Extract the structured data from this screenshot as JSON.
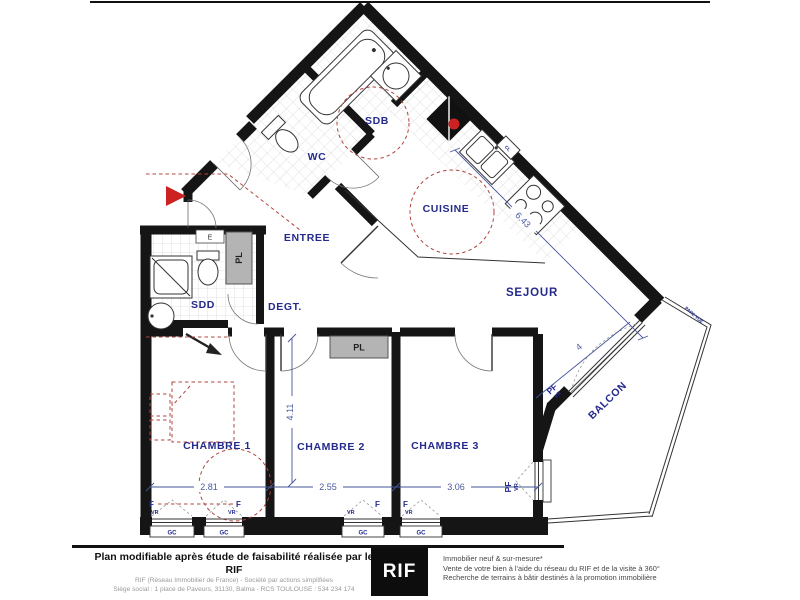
{
  "plan": {
    "rooms": {
      "sdb": "SDB",
      "wc": "WC",
      "cuisine": "CUISINE",
      "entree": "ENTREE",
      "sdd": "SDD",
      "degt": "DEGT.",
      "sejour": "SEJOUR",
      "chambre1": "CHAMBRE 1",
      "chambre2": "CHAMBRE 2",
      "chambre3": "CHAMBRE 3",
      "balcon": "BALCON"
    },
    "closets": {
      "pl": "PL",
      "e": "E",
      "cl": "CL"
    },
    "dims": {
      "sejour_ne": "6.43",
      "sejour_se": "4",
      "chambre_depth": "4.11",
      "chambre1_w": "2.81",
      "chambre2_w": "2.55",
      "chambre3_w": "3.06"
    },
    "win": {
      "f": "F",
      "vr": "VR",
      "gc": "GC",
      "pf": "PF",
      "pare_vue": "PARE VUE"
    }
  },
  "footer": {
    "title": "Plan modifiable après étude de faisabilité réalisée par le RIF",
    "sub1": "RIF (Réseau Immobilier de France) - Société par actions simplifiées",
    "sub2": "Siège social : 1 place de Paveurs, 31130, Balma - RCS TOULOUSE : 534 234 174",
    "logo": "RIF",
    "right1": "Immobilier neuf & sur-mesure*",
    "right2": "Vente de votre bien à l'aide du réseau du RIF et de la visite à 360°",
    "right3": "Recherche de terrains à bâtir destinés à la promotion immobilière"
  },
  "colors": {
    "label_navy": "#252a8c",
    "dim_blue": "#44549a",
    "accent_red": "#c0392b",
    "wall_black": "#151515",
    "closet_gray": "#b4b4b4"
  }
}
